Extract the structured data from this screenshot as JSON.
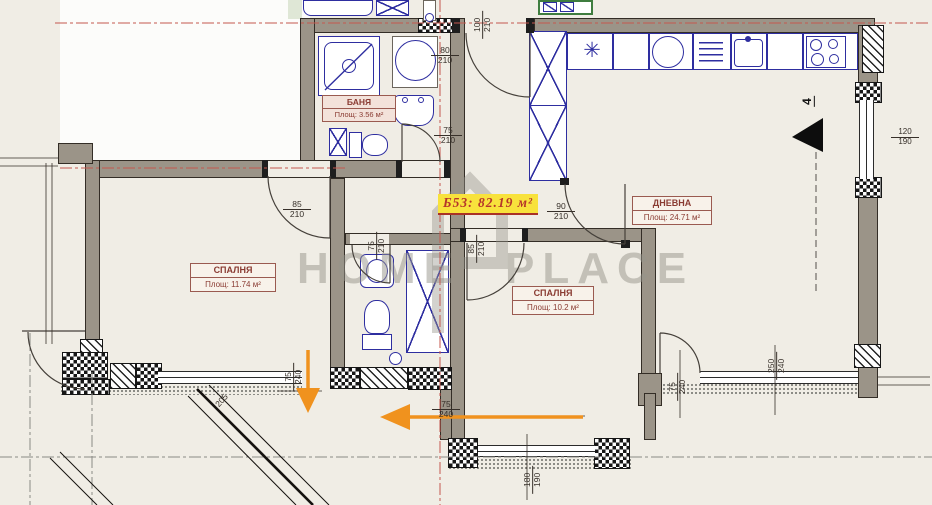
{
  "unit": {
    "area_label": "Б53: 82.19 м²",
    "marker": "4"
  },
  "rooms": [
    {
      "name": "БАНЯ",
      "area": "Площ: 3.56 м²"
    },
    {
      "name": "СПАЛНЯ",
      "area": "Площ: 11.74 м²"
    },
    {
      "name": "СПАЛНЯ",
      "area": "Площ: 10.2 м²"
    },
    {
      "name": "ДНЕВНА",
      "area": "Площ: 24.71 м²"
    }
  ],
  "dimensions": {
    "entry_door": {
      "w": "100",
      "h": "210"
    },
    "bath_window": {
      "w": "80",
      "h": "210"
    },
    "bath_door": {
      "w": "75",
      "h": "210"
    },
    "bedroom1_door": {
      "w": "85",
      "h": "210"
    },
    "wc_door": {
      "w": "75",
      "h": "210"
    },
    "bedroom2_door": {
      "w": "85",
      "h": "210"
    },
    "living_door": {
      "w": "90",
      "h": "210"
    },
    "right_window": {
      "w": "120",
      "h": "190"
    },
    "terrace_window": {
      "w": "250",
      "h": "240"
    },
    "terrace_door": {
      "w": "75",
      "h": "240"
    },
    "balcony_door": {
      "w": "75",
      "h": "240"
    },
    "balcony_exit": {
      "w": "75",
      "h": "240"
    },
    "bottom_window": {
      "w": "180",
      "h": "190"
    },
    "balcony_edge": "205"
  },
  "watermark": {
    "left": "HOME",
    "right": "PLACE"
  },
  "colors": {
    "floor": "#f0ede5",
    "wall_gray": "#9b9488",
    "fixture_blue": "#2e2ea0",
    "dashline_red": "#c4574e",
    "highlight_yellow": "#f8e23c",
    "label_maroon": "#8a3b32",
    "arrow_orange": "#f0921e"
  }
}
